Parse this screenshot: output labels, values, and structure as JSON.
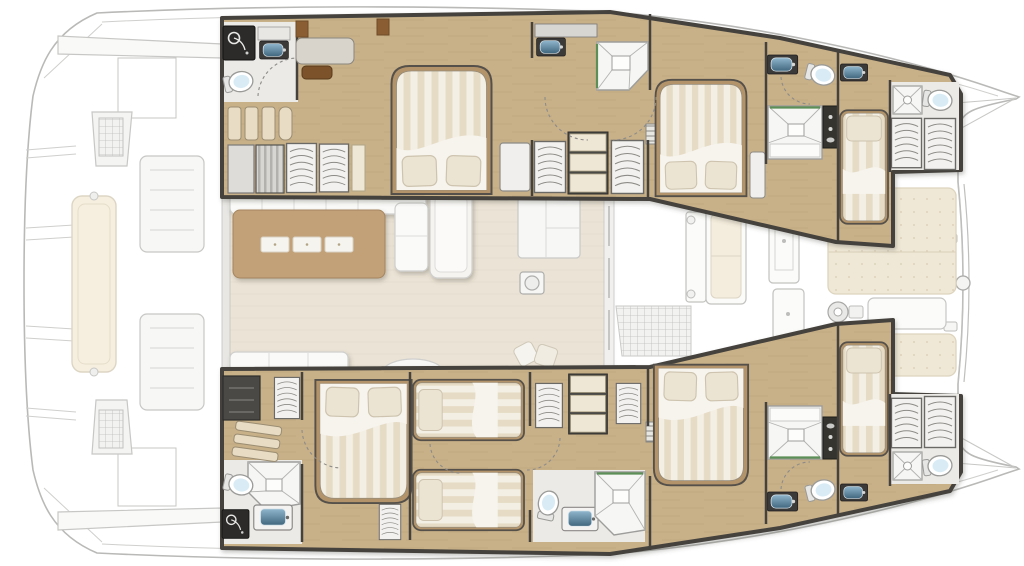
{
  "meta": {
    "title": "Catamaran deck plan",
    "view": "top-down floor plan",
    "orientation": "bow-right, stern-left",
    "style": "rendered yacht layout, exterior decks ghosted, interior vivid"
  },
  "colors": {
    "hull_stroke": "#b9b9b7",
    "ghost_line": "#c7c7c5",
    "ghost_fill": "#f9f9f7",
    "wall_dark": "#45423e",
    "wood_floor": "#c8b189",
    "wood_grain": "#a98f63",
    "salon_floor": "#ebe3d5",
    "table_tan": "#c2a078",
    "sofa_white": "#fafaf8",
    "pad_cream": "#f0e8d6",
    "mattress_light": "#f4efe4",
    "mattress_dark": "#e6dcc6",
    "sheet_white": "#f7f4ee",
    "pillow": "#ece4d3",
    "bed_frame": "#b3946a",
    "tile_floor": "#eceae6",
    "toilet_white": "#ffffff",
    "toilet_blue": "#d9ecf5",
    "sink_blue_light": "#8fb6cc",
    "sink_blue_dark": "#41677f",
    "counter_dark": "#3b3a38",
    "black_fixture": "#2c2b29",
    "shower_line": "#9d9d9b",
    "green_trim": "#5c8f57",
    "stool_brown": "#7b5229"
  },
  "vessel": {
    "type": "sailing catamaran",
    "hulls": [
      "port-hull-top",
      "starboard-hull-bottom"
    ],
    "totals": {
      "double_beds": 4,
      "single_beds": 2,
      "twin_beds": 2,
      "toilets": 7,
      "showers": 9,
      "sinks": 8,
      "wardrobes": 10
    }
  },
  "rooms": [
    {
      "id": "salon",
      "name": "Salon / bridgedeck",
      "features": [
        "dining-table",
        "placemats-x3",
        "l-shaped-sofa",
        "chaise-longue",
        "aft-sofa",
        "half-round-seat",
        "deck-hatch",
        "galley-counter"
      ]
    },
    {
      "id": "top-aft-head",
      "name": "Port aft bathroom",
      "features": [
        "dark-shower-cabin",
        "sink",
        "toilet"
      ]
    },
    {
      "id": "top-aft-cabin",
      "name": "Port aft double cabin",
      "features": [
        "double-bed",
        "vanity-desk",
        "stool",
        "slat-bench",
        "wardrobes"
      ]
    },
    {
      "id": "top-mid-head",
      "name": "Port mid bathroom",
      "features": [
        "sink",
        "shower-stall",
        "wardrobes",
        "shelves"
      ]
    },
    {
      "id": "top-mid-cabin",
      "name": "Port forward double cabin",
      "features": [
        "double-bed",
        "nightstand"
      ]
    },
    {
      "id": "top-fwd-head",
      "name": "Port forward bathroom",
      "features": [
        "sink",
        "toilet",
        "shower-stall",
        "dark-cabinet"
      ]
    },
    {
      "id": "top-fwd-cabin",
      "name": "Port bow single cabin",
      "features": [
        "single-bed",
        "sink"
      ]
    },
    {
      "id": "top-bow-head",
      "name": "Port bow bathroom",
      "features": [
        "shower-stall",
        "toilet",
        "wardrobes"
      ]
    },
    {
      "id": "bot-aft-head",
      "name": "Starboard aft bathroom",
      "features": [
        "shower-stall",
        "toilet",
        "dark-shower-cabin",
        "vanity-sink"
      ]
    },
    {
      "id": "bot-aft-cabin",
      "name": "Starboard aft double cabin",
      "features": [
        "double-bed",
        "dark-cabinet",
        "wardrobe",
        "slat-bench"
      ]
    },
    {
      "id": "bot-twin-cabin",
      "name": "Starboard twin cabin",
      "features": [
        "twin-bed",
        "twin-bed",
        "wardrobes",
        "shelves"
      ]
    },
    {
      "id": "bot-mid-head",
      "name": "Starboard mid bathroom",
      "features": [
        "toilet",
        "vanity-sink",
        "shower-stall"
      ]
    },
    {
      "id": "bot-mid-cabin",
      "name": "Starboard forward double cabin",
      "features": [
        "double-bed",
        "companionway-steps"
      ]
    },
    {
      "id": "bot-fwd-head",
      "name": "Starboard forward bathroom",
      "features": [
        "shower-stall",
        "dark-cabinet",
        "sink",
        "toilet"
      ]
    },
    {
      "id": "bot-fwd-cabin",
      "name": "Starboard bow single cabin",
      "features": [
        "single-bed",
        "sink"
      ]
    },
    {
      "id": "bot-bow-head",
      "name": "Starboard bow bathroom",
      "features": [
        "wardrobes",
        "shower-stall",
        "toilet"
      ]
    },
    {
      "id": "aft-cockpit",
      "name": "Aft cockpit (ghosted)",
      "features": [
        "transverse-bench",
        "helm-console",
        "loungers",
        "roof-edge",
        "transom-steps"
      ]
    },
    {
      "id": "fwd-cockpit",
      "name": "Forward cockpit (ghosted)",
      "features": [
        "door",
        "bench",
        "grid-mat",
        "deck-lockers"
      ]
    },
    {
      "id": "foredeck",
      "name": "Foredeck (ghosted)",
      "features": [
        "sunpads",
        "windlass",
        "anchor-locker",
        "crossbeam",
        "bow-spears"
      ]
    }
  ]
}
